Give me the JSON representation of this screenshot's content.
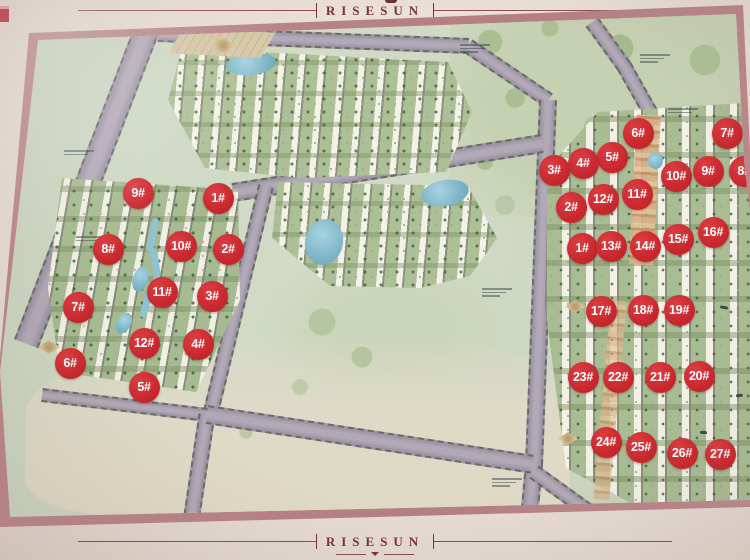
{
  "brand": {
    "top_label": "RISESUN",
    "bottom_label": "RISESUN"
  },
  "map": {
    "badges": {
      "left_zone": [
        {
          "label": "9#",
          "x": 138,
          "y": 193
        },
        {
          "label": "1#",
          "x": 218,
          "y": 198
        },
        {
          "label": "8#",
          "x": 108,
          "y": 249
        },
        {
          "label": "10#",
          "x": 181,
          "y": 246
        },
        {
          "label": "2#",
          "x": 228,
          "y": 249
        },
        {
          "label": "7#",
          "x": 78,
          "y": 307
        },
        {
          "label": "11#",
          "x": 162,
          "y": 292
        },
        {
          "label": "3#",
          "x": 212,
          "y": 296
        },
        {
          "label": "12#",
          "x": 144,
          "y": 343
        },
        {
          "label": "4#",
          "x": 198,
          "y": 344
        },
        {
          "label": "6#",
          "x": 70,
          "y": 363
        },
        {
          "label": "5#",
          "x": 144,
          "y": 387
        }
      ],
      "right_zone_upper": [
        {
          "label": "6#",
          "x": 638,
          "y": 133
        },
        {
          "label": "7#",
          "x": 727,
          "y": 133
        },
        {
          "label": "5#",
          "x": 612,
          "y": 157
        },
        {
          "label": "4#",
          "x": 583,
          "y": 163
        },
        {
          "label": "3#",
          "x": 554,
          "y": 170
        },
        {
          "label": "10#",
          "x": 676,
          "y": 176
        },
        {
          "label": "9#",
          "x": 708,
          "y": 171
        },
        {
          "label": "8#",
          "x": 744,
          "y": 171
        },
        {
          "label": "2#",
          "x": 571,
          "y": 207
        },
        {
          "label": "12#",
          "x": 603,
          "y": 199
        },
        {
          "label": "11#",
          "x": 637,
          "y": 194
        },
        {
          "label": "16#",
          "x": 713,
          "y": 232
        },
        {
          "label": "1#",
          "x": 582,
          "y": 248
        },
        {
          "label": "13#",
          "x": 611,
          "y": 246
        },
        {
          "label": "14#",
          "x": 645,
          "y": 246
        },
        {
          "label": "15#",
          "x": 678,
          "y": 239
        }
      ],
      "right_zone_lower": [
        {
          "label": "17#",
          "x": 601,
          "y": 311
        },
        {
          "label": "18#",
          "x": 643,
          "y": 310
        },
        {
          "label": "19#",
          "x": 679,
          "y": 310
        },
        {
          "label": "23#",
          "x": 583,
          "y": 377
        },
        {
          "label": "22#",
          "x": 618,
          "y": 377
        },
        {
          "label": "21#",
          "x": 660,
          "y": 377
        },
        {
          "label": "20#",
          "x": 699,
          "y": 376
        },
        {
          "label": "24#",
          "x": 606,
          "y": 442
        },
        {
          "label": "25#",
          "x": 641,
          "y": 447
        },
        {
          "label": "26#",
          "x": 682,
          "y": 453
        },
        {
          "label": "27#",
          "x": 720,
          "y": 454
        }
      ]
    }
  },
  "colors": {
    "badge_red": "#c5262c",
    "brand_maroon": "#7c3136",
    "frame_mauve": "#b98689",
    "board_cream": "#e9dfd7",
    "road_grey": "#a79eac",
    "water_blue": "#7fb6c9",
    "lake_green": "#a8bfae",
    "land_beige": "#ded8c5",
    "map_green": "#ccd6c2"
  }
}
